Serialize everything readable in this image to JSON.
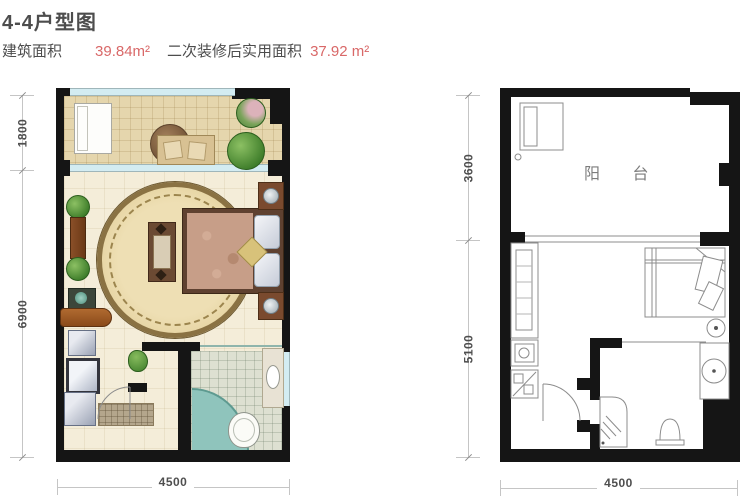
{
  "header": {
    "title": "4-4户型图",
    "area": [
      {
        "label": "建筑面积",
        "value": "39.84m²"
      },
      {
        "label": "二次装修后实用面积",
        "value": "37.92 m²"
      }
    ]
  },
  "colors": {
    "accent_red": "#d96868",
    "wall_black": "#151515",
    "window_blue": "#d3ecf2",
    "balcony_floor": "#e5d6ad",
    "room_floor": "#f4edd9",
    "bath_floor": "#dde0d1",
    "tub_teal": "#8fc4bc"
  },
  "left_plan": {
    "dims": {
      "v1": "1800",
      "v2": "6900",
      "h": "4500"
    }
  },
  "right_plan": {
    "balcony_label": "阳 台",
    "dims": {
      "v1": "3600",
      "v2": "5100",
      "h": "4500"
    }
  }
}
